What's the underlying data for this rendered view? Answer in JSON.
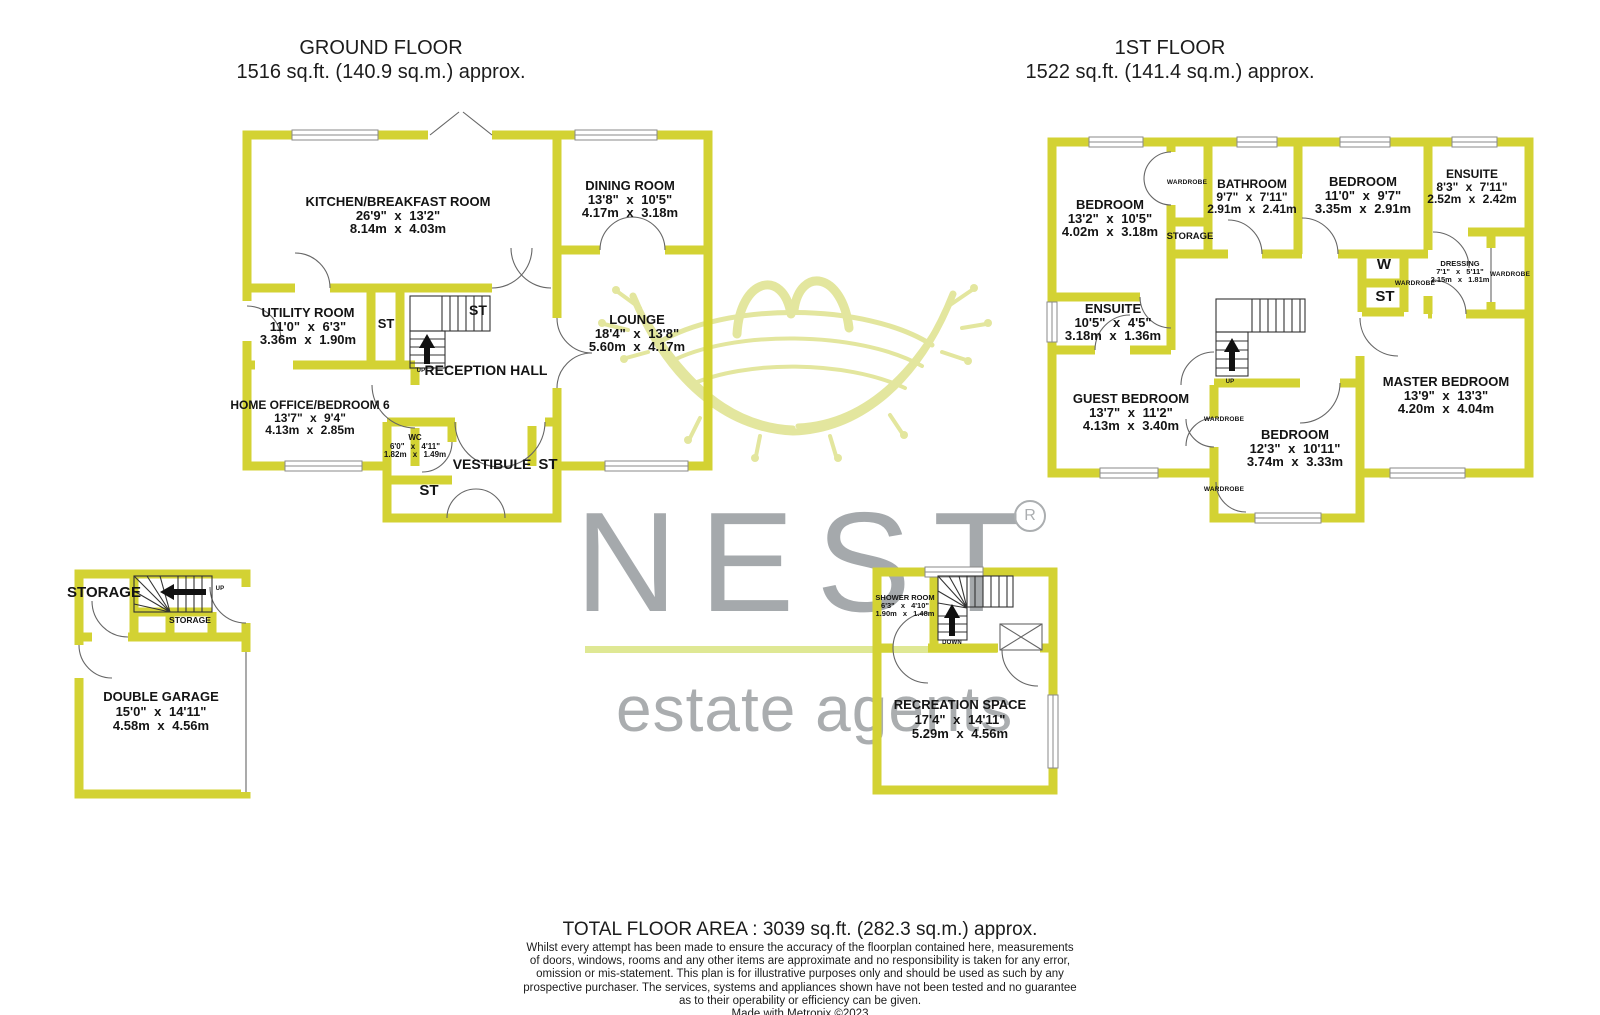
{
  "colors": {
    "wall": "#d3d233",
    "watermark_green": "#e1e496",
    "watermark_gray": "#a5a9ac",
    "text": "#141414"
  },
  "titles": {
    "ground": {
      "line1": "GROUND FLOOR",
      "line2": "1516 sq.ft. (140.9 sq.m.) approx."
    },
    "first": {
      "line1": "1ST FLOOR",
      "line2": "1522 sq.ft. (141.4 sq.m.) approx."
    }
  },
  "gf": {
    "kitchen": {
      "name": "KITCHEN/BREAKFAST ROOM",
      "imperial": "26'9\" x 13'2\"",
      "metric": "8.14m x 4.03m"
    },
    "dining": {
      "name": "DINING ROOM",
      "imperial": "13'8\" x 10'5\"",
      "metric": "4.17m x 3.18m"
    },
    "lounge": {
      "name": "LOUNGE",
      "imperial": "18'4\" x 13'8\"",
      "metric": "5.60m x 4.17m"
    },
    "utility": {
      "name": "UTILITY ROOM",
      "imperial": "11'0\" x 6'3\"",
      "metric": "3.36m x 1.90m"
    },
    "home_office": {
      "name": "HOME OFFICE/BEDROOM 6",
      "imperial": "13'7\" x 9'4\"",
      "metric": "4.13m x 2.85m"
    },
    "wc": {
      "name": "WC",
      "imperial": "6'0\" x 4'11\"",
      "metric": "1.82m x 1.49m"
    },
    "reception_hall": "RECEPTION HALL",
    "vestibule": "VESTIBULE",
    "st": "ST",
    "up": "UP"
  },
  "ff": {
    "bedroom1": {
      "name": "BEDROOM",
      "imperial": "13'2\" x 10'5\"",
      "metric": "4.02m x 3.18m"
    },
    "bathroom": {
      "name": "BATHROOM",
      "imperial": "9'7\" x 7'11\"",
      "metric": "2.91m x 2.41m"
    },
    "bedroom2": {
      "name": "BEDROOM",
      "imperial": "11'0\" x 9'7\"",
      "metric": "3.35m x 2.91m"
    },
    "ensuite_top": {
      "name": "ENSUITE",
      "imperial": "8'3\" x 7'11\"",
      "metric": "2.52m x 2.42m"
    },
    "ensuite_left": {
      "name": "ENSUITE",
      "imperial": "10'5\" x 4'5\"",
      "metric": "3.18m x 1.36m"
    },
    "guest": {
      "name": "GUEST BEDROOM",
      "imperial": "13'7\" x 11'2\"",
      "metric": "4.13m x 3.40m"
    },
    "bedroom3": {
      "name": "BEDROOM",
      "imperial": "12'3\" x 10'11\"",
      "metric": "3.74m x 3.33m"
    },
    "master": {
      "name": "MASTER BEDROOM",
      "imperial": "13'9\" x 13'3\"",
      "metric": "4.20m x 4.04m"
    },
    "dressing": {
      "name": "DRESSING",
      "imperial": "7'1\" x 5'11\"",
      "metric": "2.15m x 1.81m"
    },
    "wardrobe": "WARDROBE",
    "storage": "STORAGE",
    "w": "W",
    "st": "ST",
    "up": "UP"
  },
  "garage": {
    "double_garage": {
      "name": "DOUBLE GARAGE",
      "imperial": "15'0\" x 14'11\"",
      "metric": "4.58m x 4.56m"
    },
    "storage_large": "STORAGE",
    "storage_small": "STORAGE",
    "up": "UP"
  },
  "rec": {
    "recreation_space": {
      "name": "RECREATION SPACE",
      "imperial": "17'4\" x 14'11\"",
      "metric": "5.29m x 4.56m"
    },
    "shower": {
      "name": "SHOWER ROOM",
      "imperial": "6'3\" x 4'10\"",
      "metric": "1.90m x 1.48m"
    },
    "down": "DOWN"
  },
  "watermark": {
    "brand": "NEST",
    "reg": "R",
    "tagline": "estate agents"
  },
  "footer": {
    "total": "TOTAL FLOOR AREA : 3039 sq.ft. (282.3 sq.m.) approx.",
    "disclaimer_lines": [
      "Whilst every attempt has been made to ensure the accuracy of the floorplan contained here, measurements",
      "of doors, windows, rooms and any other items are approximate and no responsibility is taken for any error,",
      "omission or mis-statement. This plan is for illustrative purposes only and should be used as such by any",
      "prospective purchaser. The services, systems and appliances shown have not been tested and no guarantee",
      "as to their operability or efficiency can be given."
    ],
    "credit": "Made with Metropix ©2023"
  }
}
